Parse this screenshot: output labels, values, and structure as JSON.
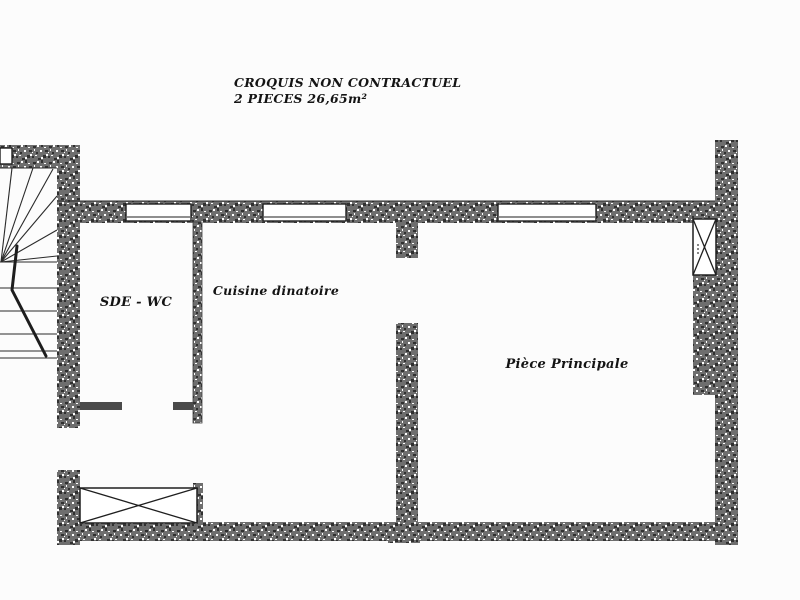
{
  "document": {
    "title_line1": "CROQUIS NON CONTRACTUEL",
    "title_line2": "2 PIECES 26,65m²"
  },
  "rooms": {
    "bathroom": "SDE - WC",
    "kitchen": "Cuisine dinatoire",
    "living": "Pièce Principale"
  },
  "colors": {
    "background": "#fcfcfc",
    "wall_fill": "#6e6e6e",
    "speck_dark": "#303030",
    "speck_light": "#ffffff",
    "line": "#1f1f1f",
    "text": "#141414"
  }
}
